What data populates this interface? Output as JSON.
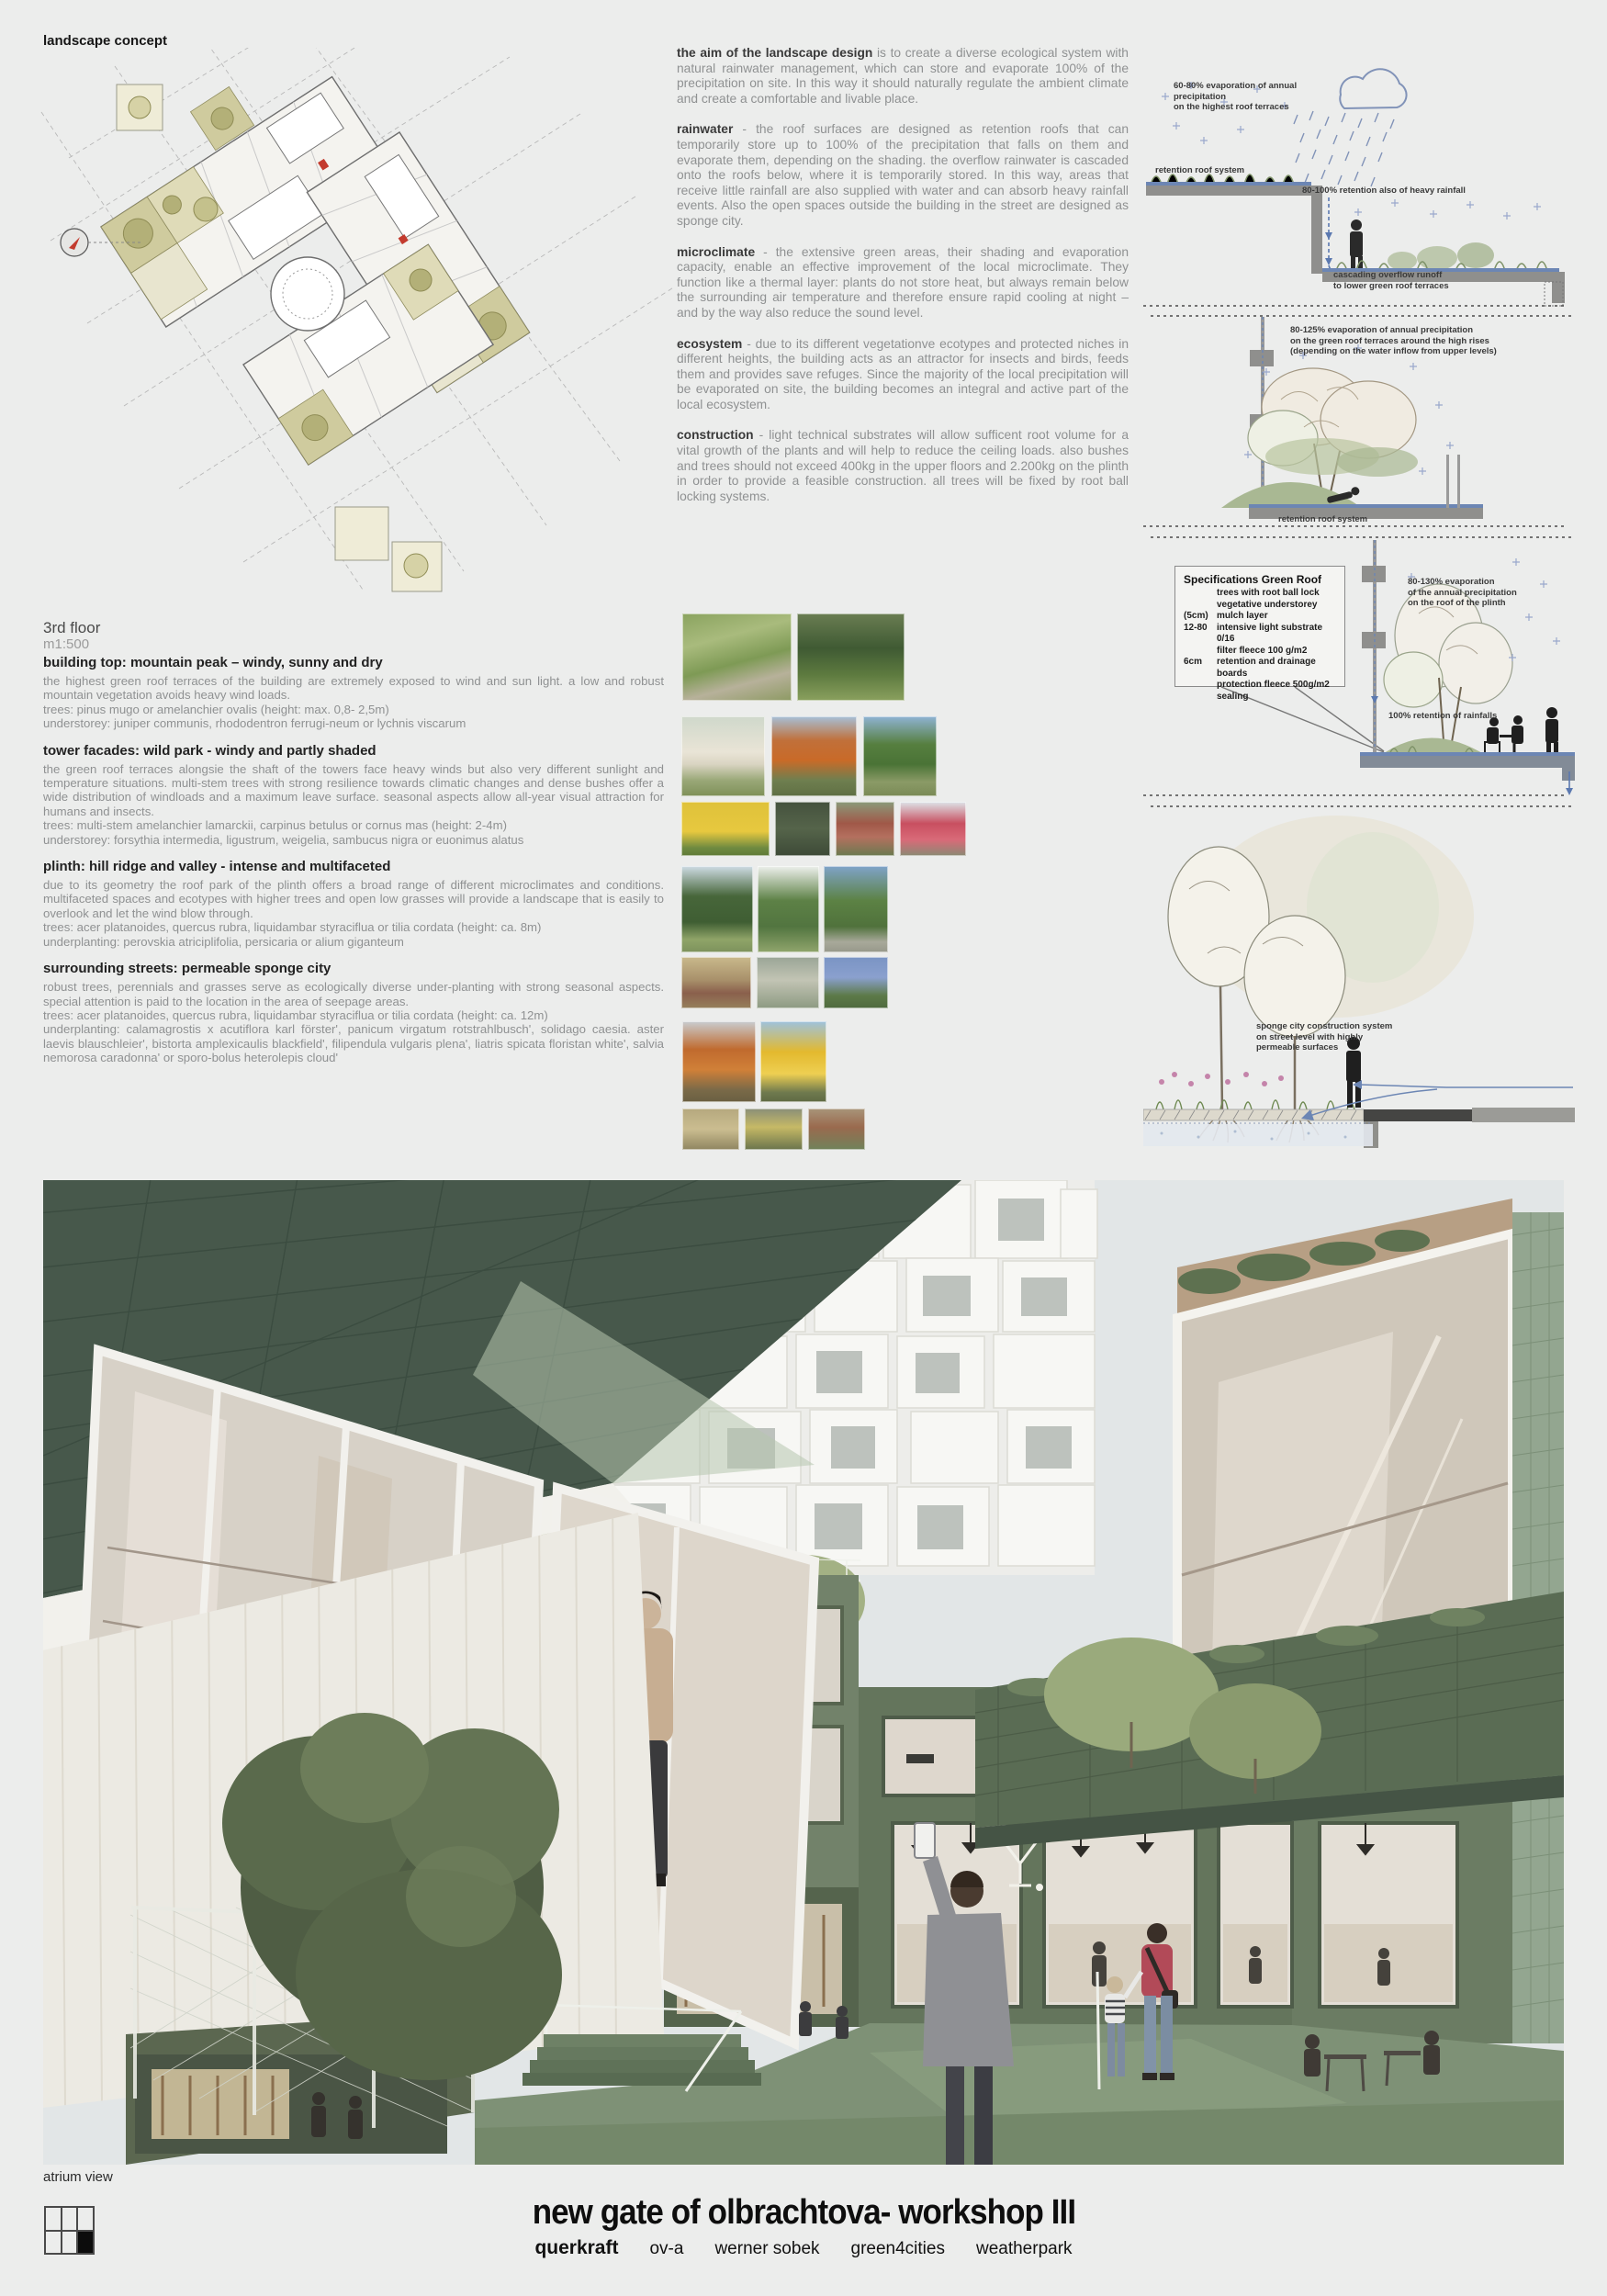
{
  "header": {
    "label": "landscape concept"
  },
  "plan": {
    "caption_line1": "3rd floor",
    "caption_line2": "m1:500"
  },
  "left_sections": [
    {
      "head": "building top: mountain peak – windy, sunny and dry",
      "body": "the highest green roof terraces of the building are extremely exposed to wind and sun light. a low and robust mountain vegetation avoids heavy wind loads.",
      "line1": "trees: pinus mugo or amelanchier ovalis (height: max. 0,8- 2,5m)",
      "line2": "understorey: juniper communis, rhododentron ferrugi-neum or lychnis viscarum"
    },
    {
      "head": "tower facades: wild park - windy and partly shaded",
      "body": "the green roof terraces alongsie the shaft of the towers face heavy winds but also very different sunlight and temperature situations. multi-stem trees with strong resilience towards climatic changes and dense bushes offer a wide distribution of windloads and a maximum leave surface. seasonal aspects allow all-year visual attraction for humans and insects.",
      "line1": "trees: multi-stem amelanchier lamarckii, carpinus betulus or cornus mas (height: 2-4m)",
      "line2": "understorey: forsythia intermedia, ligustrum, weigelia, sambucus nigra or euonimus alatus"
    },
    {
      "head": "plinth: hill ridge and valley - intense and multifaceted",
      "body": "due to its geometry the roof park of the plinth offers a broad range of different microclimates and conditions. multifaceted spaces and ecotypes with higher trees and open low grasses will provide a landscape that is easily to overlook and let the wind blow through.",
      "line1": "trees: acer platanoides, quercus rubra, liquidambar styraciflua or tilia cordata (height: ca. 8m)",
      "line2": "underplanting: perovskia atriciplifolia, persicaria or alium giganteum"
    },
    {
      "head": "surrounding streets: permeable sponge city",
      "body": "robust trees, perennials and grasses serve as ecologically diverse under-planting with strong seasonal aspects. special attention is paid to the location in the area of seepage areas.",
      "line1": "trees: acer platanoides, quercus rubra, liquidambar styraciflua or tilia cordata (height: ca. 12m)",
      "line2": "underplanting: calamagrostis x acutiflora karl förster', panicum virgatum rotstrahlbusch', solidago caesia. aster laevis  blauschleier', bistorta amplexicaulis blackfield', filipendula vulgaris  plena', liatris spicata floristan white', salvia nemorosa  caradonna' or sporo-bolus heterolepis  cloud'"
    }
  ],
  "mid_paras": [
    {
      "lead": "the aim of the landscape design",
      "text": " is to create a diverse ecological system with natural rainwater management, which can store and evaporate 100% of the precipitation on site. In this way it should naturally regulate the ambient climate and create a comfortable and livable place."
    },
    {
      "lead": "rainwater",
      "text": " - the roof surfaces are designed as retention roofs that can temporarily store up to 100% of the precipitation that falls on them and evaporate them, depending on the shading. the overflow rainwater is cascaded onto the roofs below, where it is temporarily stored. In this way, areas that receive little rainfall are also supplied with water and can absorb heavy rainfall events. Also the open spaces outside the building in the street are designed as sponge city."
    },
    {
      "lead": "microclimate",
      "text": " - the extensive green areas, their shading and evaporation capacity, enable an effective improvement of the local microclimate. They function like a thermal layer: plants do not store heat, but always remain below the surrounding air temperature and therefore ensure rapid cooling at night – and by the way also reduce the sound level."
    },
    {
      "lead": "ecosystem",
      "text": " - due to its different vegetationve ecotypes and protected niches in different heights, the building acts as an attractor for insects and birds, feeds them and provides save refuges. Since the majority of the local precipitation will be evaporated on site, the building becomes an integral and active part of the local ecosystem."
    },
    {
      "lead": "construction",
      "text": " - light technical substrates will allow sufficent root volume for a vital growth of the plants and will help to reduce the ceiling loads. also bushes and trees should not exceed 400kg in the upper floors and 2.200kg on the plinth in order to provide a feasible construction. all trees will be fixed by root ball locking systems."
    }
  ],
  "diagrams": {
    "d1": {
      "evap": "60-80% evaporation of annual precipitation\non the highest roof terraces",
      "roof": "retention roof system",
      "retention": "80-100% retention also of heavy rainfall",
      "cascade": "cascading overflow runoff\nto lower green roof terraces"
    },
    "d2": {
      "evap": "80-125% evaporation of annual precipitation\non the green roof terraces around the high rises\n(depending on the water inflow from upper levels)",
      "roof": "retention roof system"
    },
    "d3": {
      "spec_title": "Specifications Green Roof",
      "rows": [
        {
          "k": "",
          "t": "trees with root ball lock"
        },
        {
          "k": "",
          "t": "vegetative understorey"
        },
        {
          "k": "(5cm)",
          "t": "mulch layer"
        },
        {
          "k": "12-80",
          "t": "intensive light substrate 0/16"
        },
        {
          "k": "",
          "t": "filter fleece 100 g/m2"
        },
        {
          "k": "6cm",
          "t": "retention and drainage boards"
        },
        {
          "k": "",
          "t": "protection fleece 500g/m2"
        },
        {
          "k": "",
          "t": "sealing"
        }
      ],
      "evap": "80-130% evaporation\nof the annual precipitation\non the roof of the plinth",
      "retention": "100% retention of rainfalls"
    },
    "d4": {
      "label": "sponge city construction system\non street level with highly\npermeable surfaces"
    }
  },
  "photos": [
    {
      "name": "alpine-rock-garden",
      "bg": "linear-gradient(165deg,#8aa35f 0%,#a9bb7d 30%,#7e9a55 55%,#b7b19a 75%,#8d9a63 100%)"
    },
    {
      "name": "pinus-mugo-shrubs",
      "bg": "linear-gradient(180deg,#6a7d52 0%,#3f5a33 40%,#5d7a3f 70%,#8aa05e 100%)"
    },
    {
      "name": "amelanchier-white-bloom",
      "bg": "linear-gradient(180deg,#cfd8cb 0%,#e9e4d6 45%,#d9d4c2 60%,#9aa878 80%,#7e9058 100%)"
    },
    {
      "name": "multistem-tree-orange",
      "bg": "linear-gradient(180deg,#a7c0d8 0%,#c0703a 30%,#c96a28 55%,#6f7f4f 80%,#5f6f44 100%)"
    },
    {
      "name": "multistem-tree-green",
      "bg": "linear-gradient(180deg,#8fb3d4 0%,#567f3f 35%,#4a7336 60%,#8a9a66 82%,#7a8a56 100%)"
    },
    {
      "name": "forsythia-yellow",
      "bg": "linear-gradient(180deg,#dfc23a 0%,#e7c83f 55%,#6f8a40 85%,#5f7a38 100%)"
    },
    {
      "name": "dark-hedge",
      "bg": "linear-gradient(180deg,#45523e 0%,#55644a 50%,#3d4a37 100%)"
    },
    {
      "name": "red-leaved-shrub",
      "bg": "linear-gradient(180deg,#8a9a7a 0%,#a05848 40%,#b4705f 65%,#6a7a50 100%)"
    },
    {
      "name": "euonymus-red-bush",
      "bg": "linear-gradient(180deg,#dde4e8 0%,#c84f60 40%,#d96a78 70%,#8a8a74 100%)"
    },
    {
      "name": "acer-platanoides-tree",
      "bg": "linear-gradient(180deg,#cfdce5 0%,#47663a 35%,#3f5e33 65%,#8fa468 85%,#7d925c 100%)"
    },
    {
      "name": "quercus-rubra-tree",
      "bg": "linear-gradient(180deg,#eef0ed 0%,#5d8146 40%,#527540 70%,#90a56c 100%)"
    },
    {
      "name": "tilia-cordata-tree",
      "bg": "linear-gradient(180deg,#7fa3c9 0%,#5c8244 40%,#50723c 70%,#a8a99a 88%,#97988a 100%)"
    },
    {
      "name": "persicaria-grasses",
      "bg": "linear-gradient(180deg,#c9b98c 0%,#a8906a 45%,#8a5f4c 70%,#96805c 100%)"
    },
    {
      "name": "flower-meadow",
      "bg": "linear-gradient(180deg,#9aa596 0%,#c2c4b4 45%,#8d9a82 100%)"
    },
    {
      "name": "blue-salvia-planting",
      "bg": "linear-gradient(180deg,#7a94c4 0%,#8aa0ce 40%,#5d7a48 75%,#4e6a3e 100%)"
    },
    {
      "name": "street-tree-orange-autumn",
      "bg": "linear-gradient(180deg,#c9cdd1 0%,#c06a2e 35%,#d08038 60%,#7a6a48 85%,#6a5f42 100%)"
    },
    {
      "name": "street-tree-yellow-autumn",
      "bg": "linear-gradient(180deg,#9ec2de 0%,#e3b92e 38%,#eecf52 65%,#6f7a4e 88%,#5f6a44 100%)"
    },
    {
      "name": "ornamental-grasses",
      "bg": "linear-gradient(180deg,#b5a87e 0%,#cbbd90 50%,#8f8560 100%)"
    },
    {
      "name": "yellow-perennials",
      "bg": "linear-gradient(180deg,#8a8f78 0%,#c6b966 45%,#6a744c 100%)"
    },
    {
      "name": "groundcover-planting",
      "bg": "linear-gradient(180deg,#a8957a 0%,#9a6a4e 45%,#70825a 100%)"
    }
  ],
  "rendering": {
    "label": "atrium view",
    "sign": "co/work."
  },
  "footer": {
    "title": "new gate of olbrachtova- workshop III",
    "credits": [
      "querkraft",
      "ov-a",
      "werner sobek",
      "green4cities",
      "weatherpark"
    ]
  }
}
